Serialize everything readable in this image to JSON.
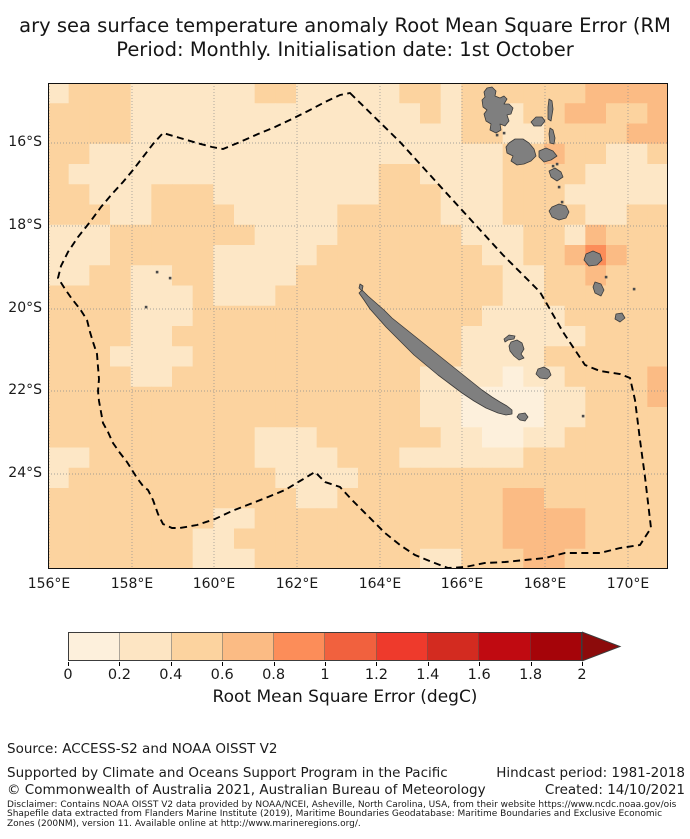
{
  "title": {
    "line1_visible": "ary sea surface temperature anomaly Root Mean Square Error (RM",
    "line2": "Period: Monthly. Initialisation date: 1st October"
  },
  "map": {
    "extent_note": "lon 156E-171E, lat 14.5S-26.3S",
    "land_color": "#7f7f7f",
    "land_edge_color": "#3a3a3a",
    "gridline_color": "#8f8f8f",
    "eez_color": "#000000",
    "cell_palette": {
      "1": "#fdf0dc",
      "2": "#fde7c6",
      "3": "#fcd39f",
      "4": "#fbbb84",
      "5": "#fc8d59"
    },
    "grid_cols": 30,
    "grid_rows": 24,
    "grid": [
      "233322222233222223323333334444",
      "333322222222222222323323344334",
      "333322222222222222223322333344",
      "332222222222222222222233433223",
      "322222222222222233222233332222",
      "332223332222222233322233322222",
      "333223333222223333322233332233",
      "222333333322223333332223324333",
      "222333332222233333333223345433",
      "223322332222333333333322334333",
      "333322232223333333333322333333",
      "333322233333333333333222233333",
      "333322333333333333332222223333",
      "333222233333333333332222333333",
      "333322333333333333222212233334",
      "333333333333333333221111223334",
      "333333333333333333221111223333",
      "333333333322233333322112233333",
      "223333333322223332222223333333",
      "233333333332222333333333333333",
      "333333333333223333333344333333",
      "333333332233333333333344443333",
      "333333322333333333333344443333",
      "333333322233333333223334433333"
    ],
    "meridians": [
      {
        "label": "156°E",
        "x": 1
      },
      {
        "label": "158°E",
        "x": 84
      },
      {
        "label": "160°E",
        "x": 166
      },
      {
        "label": "162°E",
        "x": 249
      },
      {
        "label": "164°E",
        "x": 332
      },
      {
        "label": "166°E",
        "x": 414
      },
      {
        "label": "168°E",
        "x": 497
      },
      {
        "label": "170°E",
        "x": 580
      }
    ],
    "parallels": [
      {
        "label": "16°S",
        "y": 60
      },
      {
        "label": "18°S",
        "y": 143
      },
      {
        "label": "20°S",
        "y": 226
      },
      {
        "label": "22°S",
        "y": 308
      },
      {
        "label": "24°S",
        "y": 391
      }
    ],
    "eez_points": "302,10 352,59 402,114 455,172 492,209 515,249 537,282 552,288 572,291 582,295 587,317 592,357 597,394 603,445 592,462 572,465 552,470 537,470 517,470 497,475 477,477 457,479 437,480 417,484 400,485 384,479 367,472 352,462 337,450 320,433 304,417 292,404 277,399 267,389 252,398 237,407 220,414 202,421 184,428 167,436 149,442 132,445 124,445 115,441 110,431 105,417 100,407 95,403 89,395 84,387 79,379 72,370 65,360 60,349 55,340 53,329 51,318 50,308 51,296 50,284 49,271 45,259 42,249 39,237 32,226 24,216 17,206 10,195 13,183 20,169 30,154 42,139 53,124 64,111 75,99 85,87 95,74 105,61 115,50 132,55 149,60 164,64 175,66 192,59 210,51 227,44 244,36 260,28 277,19 292,12",
    "islands": [
      {
        "name": "grande-terre",
        "points": "314,207 320,213 328,220 336,227 344,235 354,243 364,251 374,259 384,267 394,275 404,283 414,291 424,299 434,307 444,314 452,319 459,323 464,327 464,331 458,332 450,330 438,325 426,318 414,310 402,301 390,292 378,282 366,272 356,262 346,252 338,244 330,235 322,226 316,217 311,210"
      },
      {
        "name": "belep",
        "points": "312,201 315,203 314,208 311,205"
      },
      {
        "name": "ile-des-pins",
        "points": "471,331 477,330 480,334 477,338 472,337 469,334"
      },
      {
        "name": "ouvea",
        "points": "456,256 461,252 467,253 466,256 460,257 457,259"
      },
      {
        "name": "lifou",
        "points": "463,259 469,257 474,260 476,266 473,271 476,275 471,277 466,273 462,268 461,263"
      },
      {
        "name": "mare",
        "points": "490,286 496,284 501,287 503,292 499,296 492,295 488,291"
      },
      {
        "name": "espiritu-santo",
        "points": "436,9 439,5 444,4 448,8 447,13 452,15 456,13 459,16 456,21 461,21 465,25 463,31 459,32 461,38 457,43 452,41 453,47 448,50 442,47 443,41 438,38 436,31 439,27 435,24 434,17 437,14"
      },
      {
        "name": "malakula",
        "points": "461,60 467,56 475,56 481,60 486,66 488,73 483,78 476,81 469,82 463,78 465,73 459,70 458,64"
      },
      {
        "name": "ambae",
        "points": "483,39 488,34 494,34 497,38 493,43 486,43"
      },
      {
        "name": "maewo",
        "points": "501,16 504,18 505,26 503,38 500,36 500,24"
      },
      {
        "name": "pentecost",
        "points": "502,45 505,47 507,55 506,61 502,60 501,51"
      },
      {
        "name": "ambrym",
        "points": "491,68 498,65 505,68 509,73 503,77 496,79 491,74"
      },
      {
        "name": "epi",
        "points": "501,88 507,85 513,89 515,94 509,98 503,94"
      },
      {
        "name": "efate",
        "points": "504,124 511,121 518,123 521,129 518,135 511,137 504,134 501,128"
      },
      {
        "name": "erromango",
        "points": "538,171 545,168 552,171 554,177 549,182 541,183 536,177"
      },
      {
        "name": "tanna",
        "points": "547,199 553,201 556,207 553,213 547,210 545,204"
      },
      {
        "name": "aneityum",
        "points": "568,231 574,230 577,235 572,239 567,236"
      }
    ],
    "islet_dots": [
      [
        109,
        189
      ],
      [
        122,
        195
      ],
      [
        98,
        224
      ],
      [
        509,
        81
      ],
      [
        505,
        83
      ],
      [
        511,
        104
      ],
      [
        514,
        119
      ],
      [
        558,
        194
      ],
      [
        586,
        206
      ],
      [
        535,
        333
      ],
      [
        449,
        52
      ],
      [
        456,
        50
      ]
    ]
  },
  "colorbar": {
    "bins": [
      "#fdf0dc",
      "#fde5c3",
      "#fcd39f",
      "#fbbb84",
      "#fc8d59",
      "#f1613e",
      "#ee3a2c",
      "#d32b20",
      "#c00a11",
      "#a50409"
    ],
    "arrow_color": "#8c0b0b",
    "tick_labels": [
      "0",
      "0.2",
      "0.4",
      "0.6",
      "0.8",
      "1",
      "1.2",
      "1.4",
      "1.6",
      "1.8",
      "2"
    ],
    "axis_label": "Root Mean Square Error (degC)",
    "range": [
      0,
      2
    ],
    "step": 0.2
  },
  "footer": {
    "source": "Source: ACCESS-S2 and NOAA OISST V2",
    "supported": "Supported by Climate and Oceans Support Program in the Pacific",
    "hindcast": "Hindcast period: 1981-2018",
    "copyright": "© Commonwealth of Australia 2021, Australian Bureau of Meteorology",
    "created": "Created: 14/10/2021",
    "disclaimer_lines": [
      "Disclaimer: Contains NOAA OISST V2 data provided by NOAA/NCEI, Asheville, North Carolina, USA, from their website https://www.ncdc.noaa.gov/ois",
      "Shapefile data extracted from Flanders Marine Institute (2019), Maritime Boundaries Geodatabase: Maritime Boundaries and Exclusive Economic",
      "Zones (200NM), version 11. Available online at http://www.marineregions.org/."
    ]
  }
}
